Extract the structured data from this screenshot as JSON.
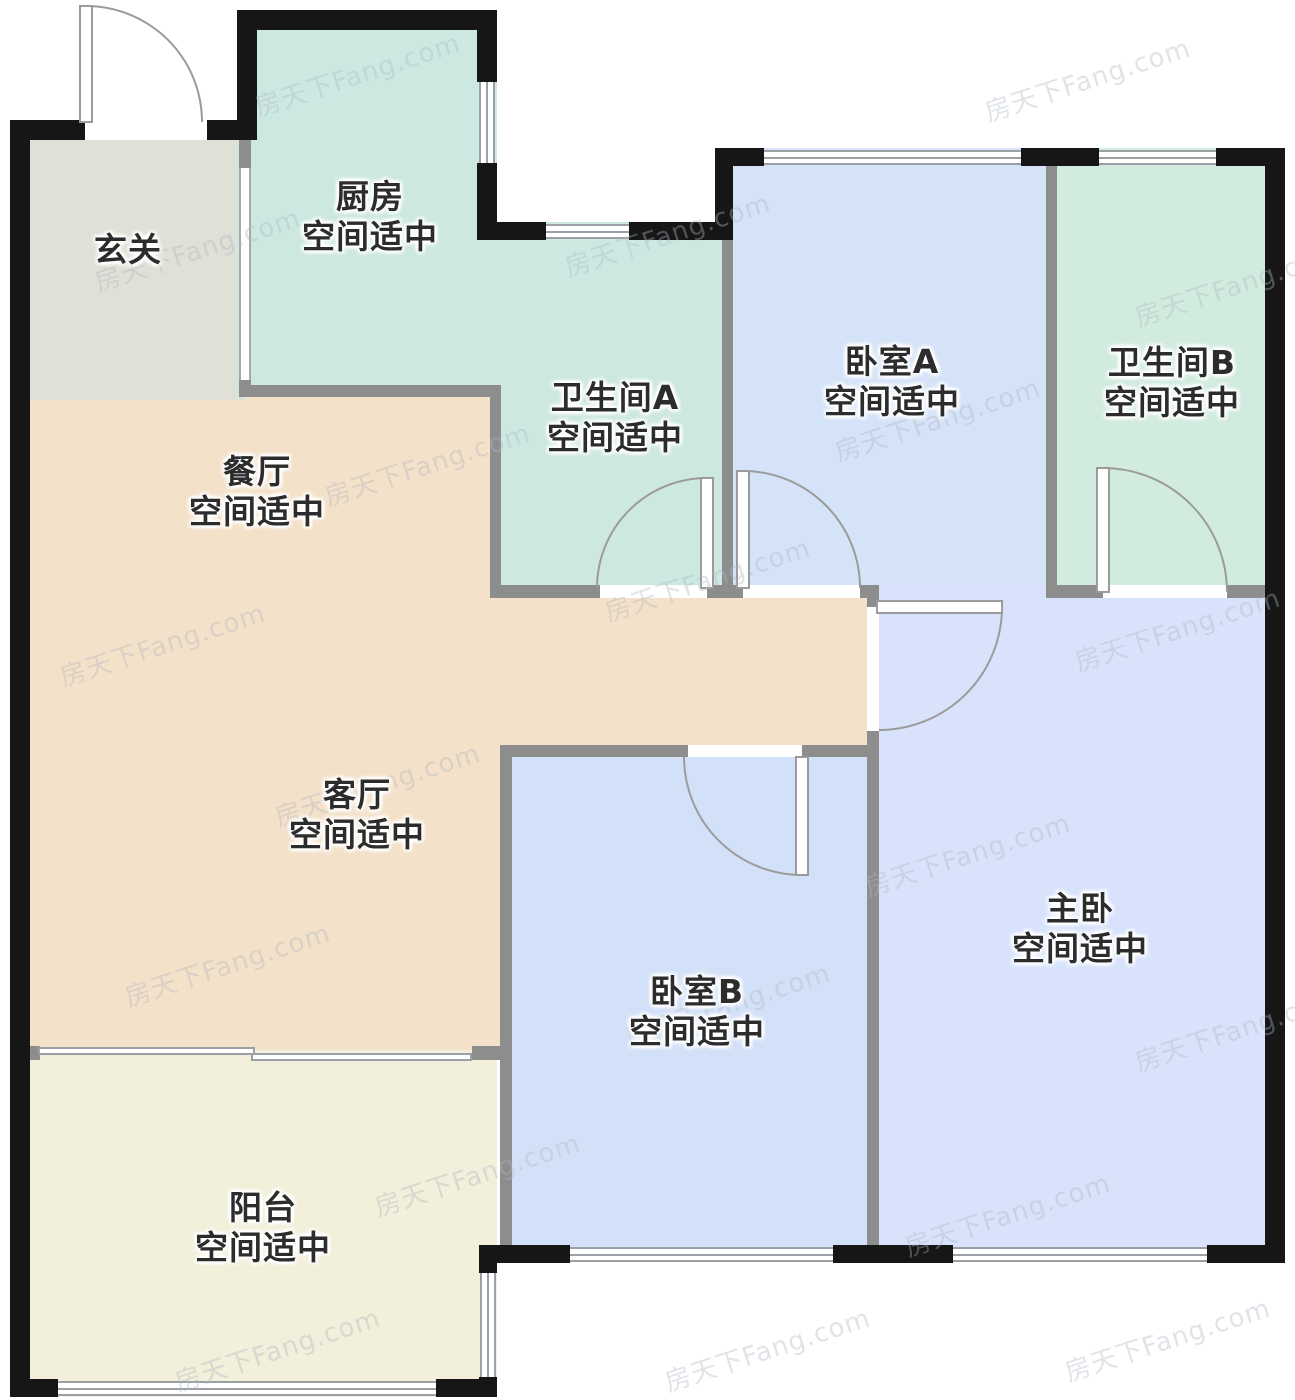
{
  "watermark": {
    "text": "房天下Fang.com"
  },
  "rooms": [
    {
      "id": "foyer",
      "name": "玄关",
      "subtitle": ""
    },
    {
      "id": "kitchen",
      "name": "厨房",
      "subtitle": "空间适中"
    },
    {
      "id": "bathroom-a",
      "name": "卫生间A",
      "subtitle": "空间适中"
    },
    {
      "id": "bedroom-a",
      "name": "卧室A",
      "subtitle": "空间适中"
    },
    {
      "id": "bathroom-b",
      "name": "卫生间B",
      "subtitle": "空间适中"
    },
    {
      "id": "dining",
      "name": "餐厅",
      "subtitle": "空间适中"
    },
    {
      "id": "living",
      "name": "客厅",
      "subtitle": "空间适中"
    },
    {
      "id": "bedroom-b",
      "name": "卧室B",
      "subtitle": "空间适中"
    },
    {
      "id": "master",
      "name": "主卧",
      "subtitle": "空间适中"
    },
    {
      "id": "balcony",
      "name": "阳台",
      "subtitle": "空间适中"
    }
  ],
  "colors": {
    "outer_wall": "#161616",
    "inner_wall": "#8d8d8d",
    "window_line": "#9aa0a6",
    "door_line": "#9b9b9b",
    "foyer": "#dfe0d6",
    "kitchen": "#cde8e0",
    "bathroom_a": "#cde8e0",
    "bedroom_a": "#d5e3f8",
    "bathroom_b": "#d2ebdf",
    "dining_living": "#f4e1c9",
    "bedroom_b": "#d3e1f8",
    "master": "#d8e3fb",
    "balcony": "#f2efda",
    "label_text": "#2c2c2c"
  }
}
